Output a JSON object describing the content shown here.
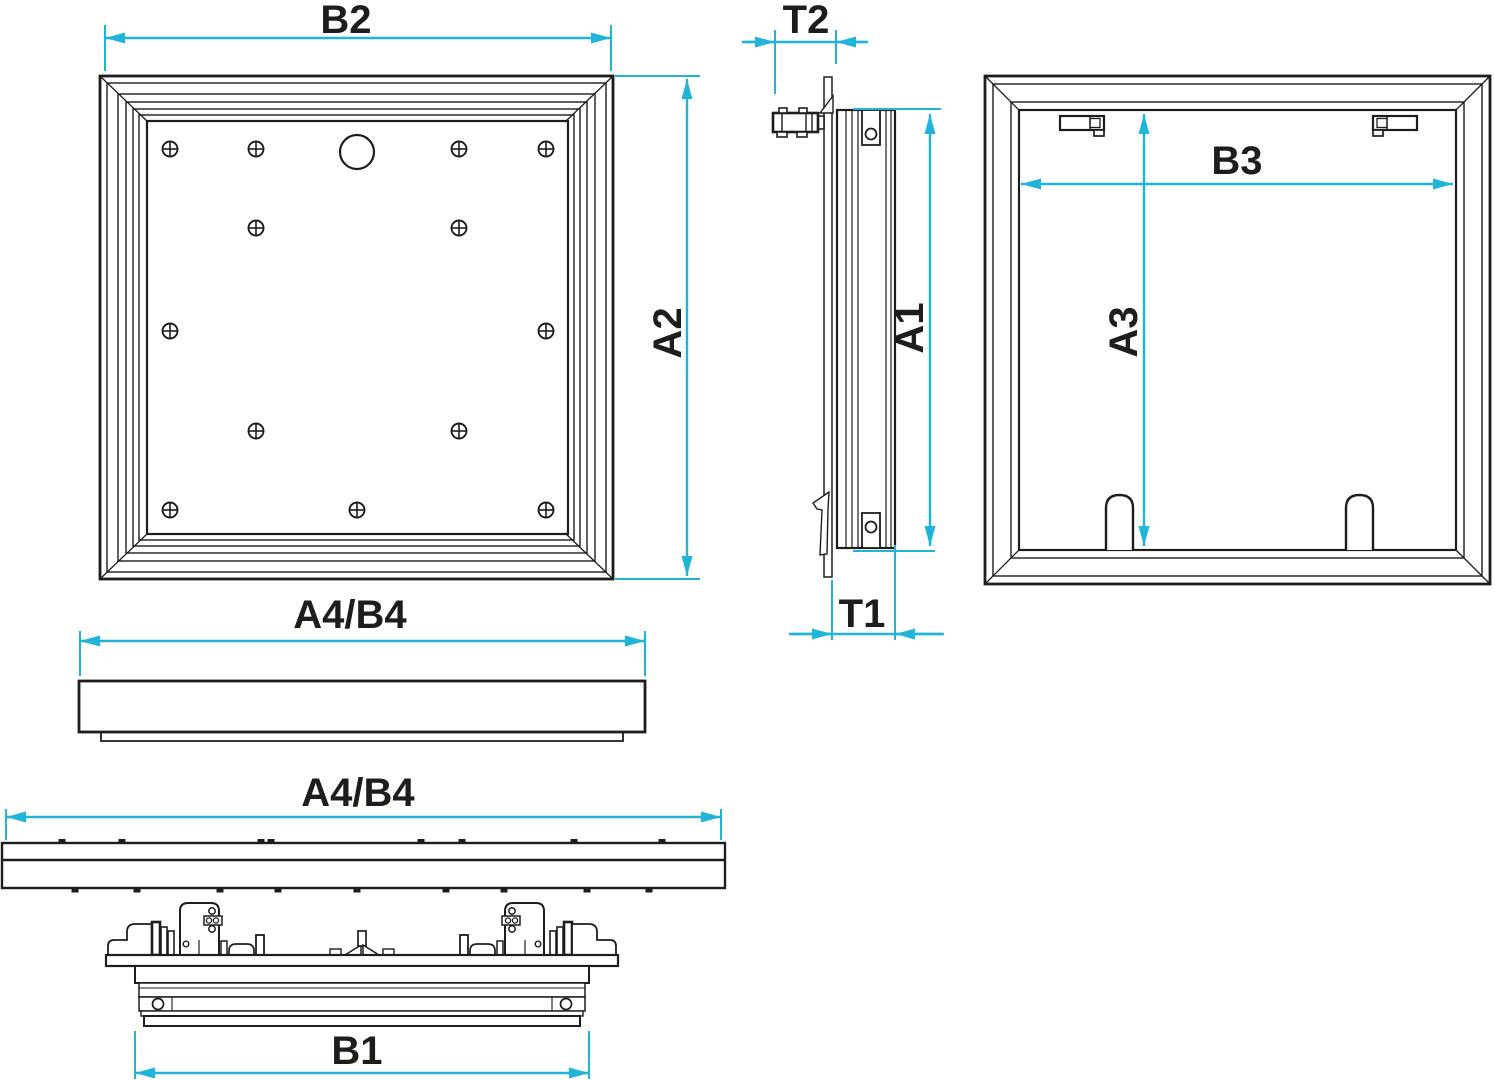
{
  "drawing": {
    "type": "technical-drawing",
    "subject": "access-panel dimensional views",
    "colors": {
      "line": "#1d1d1b",
      "dimension": "#1fb4d8",
      "background": "#ffffff"
    },
    "views": {
      "front": {
        "name": "front view",
        "width_label": "B2",
        "height_label": "A2",
        "screw_count": 13,
        "hole_count": 1
      },
      "side": {
        "name": "side section",
        "height_label": "A1",
        "door_protrusion_label": "T2",
        "frame_depth_label": "T1"
      },
      "rear": {
        "name": "rear view",
        "width_label": "B3",
        "height_label": "A3",
        "latch_count": 2,
        "hinge_tab_count": 2
      },
      "cover_profile": {
        "name": "cover profile",
        "width_label": "A4/B4"
      },
      "frame_section": {
        "name": "frame section",
        "width_label": "A4/B4",
        "inner_width_label": "B1"
      }
    }
  }
}
